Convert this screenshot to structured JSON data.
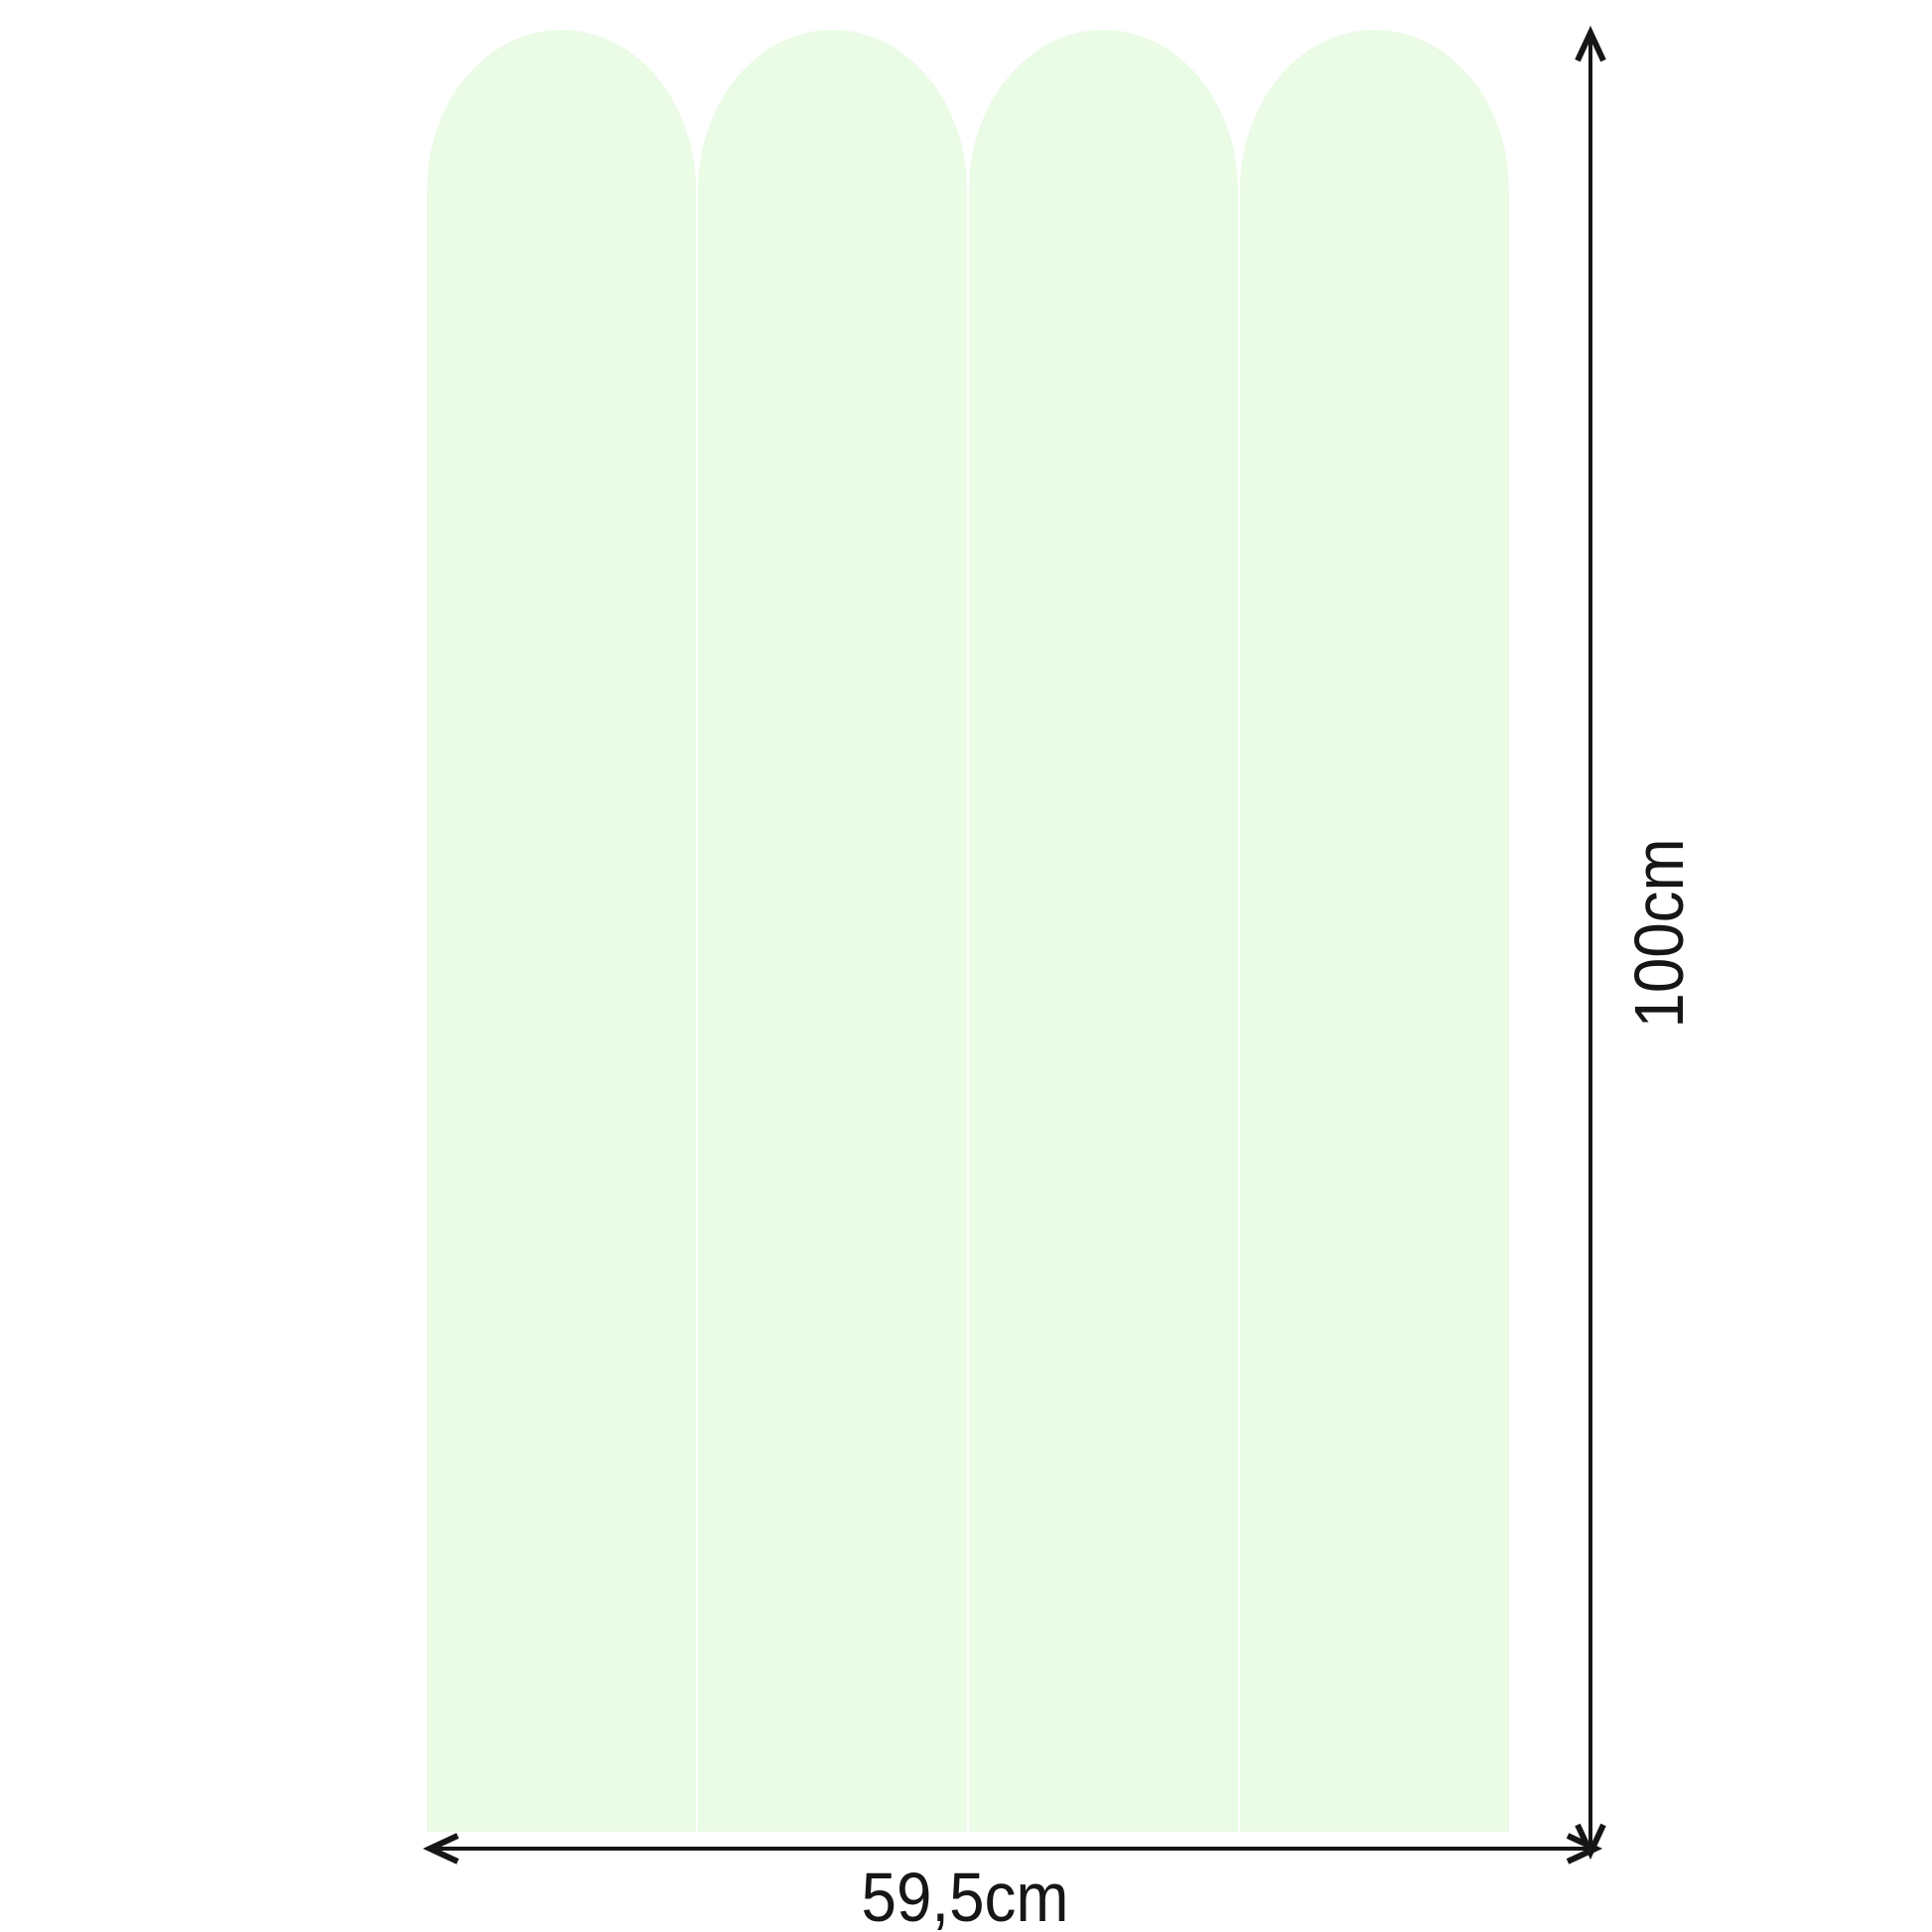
{
  "diagram": {
    "description": "Product dimension diagram of four arched wall panels",
    "background_color": "#ffffff",
    "panels": {
      "count": 4,
      "fill": "#eafbe6"
    },
    "dimensions": {
      "width": {
        "label": "59,5cm"
      },
      "height": {
        "label": "100cm"
      }
    },
    "arrow_color": "#161616"
  }
}
